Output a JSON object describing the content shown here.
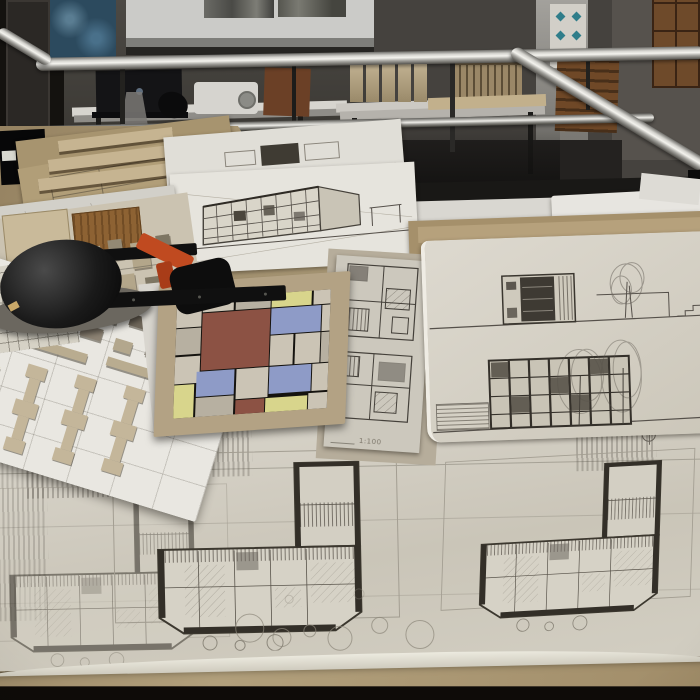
{
  "meta": {
    "type": "photograph",
    "setting": "architecture studio crit table",
    "description": "A review table in an architecture school covered with cardboard sheets, pencil floor plans and elevations on tracing paper, a Mondrian-style color composition board, cardboard site-model pieces and a black drafting-machine head. Behind a steel railing, a dark room with a projection screen showing two grayscale photos, a laptop, a projector, cardboard study models on tables, a diamond-pattern poster and wooden lockers."
  },
  "labels": {
    "plan_strip_scale": "1:100"
  },
  "palette": {
    "room_dark": "#2a2825",
    "railing_steel": "#d6d5d0",
    "cardboard": "#a8936f",
    "tracing_paper": "#d6d2c7",
    "pencil_line": "#47433a",
    "drafting_head_orange": "#c04a20",
    "mondrian_red": "#8c5244",
    "mondrian_blue": "#8e9bc7",
    "mondrian_yellow": "#d8d58c",
    "mondrian_greige": "#cbc4b5",
    "poster_teal": "#2f7d8a",
    "locker_wood": "#6e4a2a"
  },
  "mondrian": {
    "colors": {
      "g": "#cbc4b5",
      "g2": "#b7b0a1",
      "r": "#8c5244",
      "b": "#8e9bc7",
      "y": "#d8d58c"
    },
    "tiles": [
      {
        "x": 0,
        "y": 0,
        "w": 16,
        "h": 24,
        "c": "g"
      },
      {
        "x": 17,
        "y": 0,
        "w": 20,
        "h": 12,
        "c": "g"
      },
      {
        "x": 38,
        "y": 0,
        "w": 23,
        "h": 12,
        "c": "g2"
      },
      {
        "x": 62,
        "y": 0,
        "w": 26,
        "h": 12,
        "c": "y"
      },
      {
        "x": 89,
        "y": 0,
        "w": 11,
        "h": 12,
        "c": "g"
      },
      {
        "x": 0,
        "y": 25,
        "w": 16,
        "h": 22,
        "c": "g2"
      },
      {
        "x": 17,
        "y": 13,
        "w": 44,
        "h": 48,
        "c": "r"
      },
      {
        "x": 62,
        "y": 13,
        "w": 32,
        "h": 22,
        "c": "b"
      },
      {
        "x": 95,
        "y": 13,
        "w": 5,
        "h": 22,
        "c": "g"
      },
      {
        "x": 62,
        "y": 36,
        "w": 15,
        "h": 25,
        "c": "g"
      },
      {
        "x": 78,
        "y": 36,
        "w": 16,
        "h": 25,
        "c": "g"
      },
      {
        "x": 95,
        "y": 36,
        "w": 5,
        "h": 25,
        "c": "g2"
      },
      {
        "x": 0,
        "y": 48,
        "w": 16,
        "h": 23,
        "c": "g"
      },
      {
        "x": 0,
        "y": 72,
        "w": 13,
        "h": 28,
        "c": "y"
      },
      {
        "x": 14,
        "y": 62,
        "w": 25,
        "h": 21,
        "c": "b"
      },
      {
        "x": 40,
        "y": 62,
        "w": 21,
        "h": 25,
        "c": "g"
      },
      {
        "x": 62,
        "y": 62,
        "w": 27,
        "h": 23,
        "c": "b"
      },
      {
        "x": 90,
        "y": 62,
        "w": 10,
        "h": 23,
        "c": "g"
      },
      {
        "x": 14,
        "y": 84,
        "w": 25,
        "h": 16,
        "c": "g2"
      },
      {
        "x": 40,
        "y": 88,
        "w": 19,
        "h": 12,
        "c": "r"
      },
      {
        "x": 60,
        "y": 88,
        "w": 27,
        "h": 12,
        "c": "y"
      },
      {
        "x": 88,
        "y": 86,
        "w": 12,
        "h": 14,
        "c": "g"
      }
    ]
  },
  "objects": [
    {
      "name": "projection-screen",
      "label": "screen with two grayscale site photos"
    },
    {
      "name": "laptop",
      "label": "black HP laptop"
    },
    {
      "name": "projector",
      "label": "white projector"
    },
    {
      "name": "study-models",
      "label": "cardboard massing models"
    },
    {
      "name": "railing",
      "label": "stainless steel guard railing"
    },
    {
      "name": "drafting-head",
      "label": "drafting machine head with orange lever"
    },
    {
      "name": "mondrian-board",
      "label": "color composition study on cardboard"
    },
    {
      "name": "site-pieces-board",
      "label": "white board with cardboard building pieces"
    },
    {
      "name": "plan-strip",
      "label": "strip of small unit plans, scale 1:100"
    },
    {
      "name": "elevation-sheet",
      "label": "pencil elevations on tracing paper"
    },
    {
      "name": "floor-plan-sheet",
      "label": "large tracing sheet with two L-shaped floor plans"
    }
  ]
}
